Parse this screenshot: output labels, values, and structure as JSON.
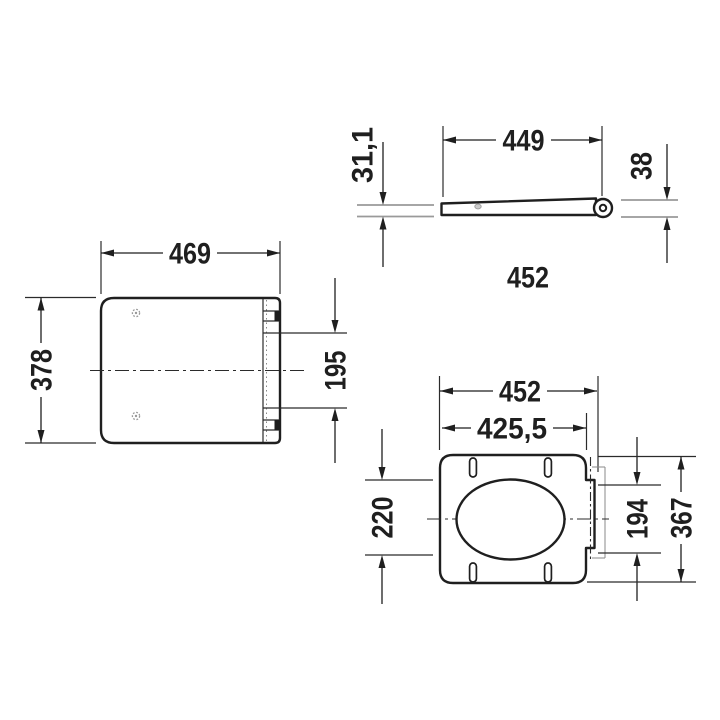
{
  "drawing": {
    "type": "technical-dimension-drawing",
    "units": "mm",
    "side_profile_view": {
      "dim_length_seat": "449",
      "dim_thickness_front": "31,1",
      "dim_thickness_hinge": "38",
      "dim_overall_length": "452"
    },
    "lid_top_view": {
      "dim_width": "469",
      "dim_depth": "378",
      "dim_hinge_span": "195"
    },
    "seat_top_view": {
      "dim_width_overall": "452",
      "dim_width_hinge": "425,5",
      "dim_opening_depth": "220",
      "dim_hinge_plate_depth": "194",
      "dim_depth_overall": "367"
    }
  },
  "colors": {
    "line": "#1f1f1f",
    "extension_gray": "#9a9a9a",
    "background": "#ffffff"
  }
}
